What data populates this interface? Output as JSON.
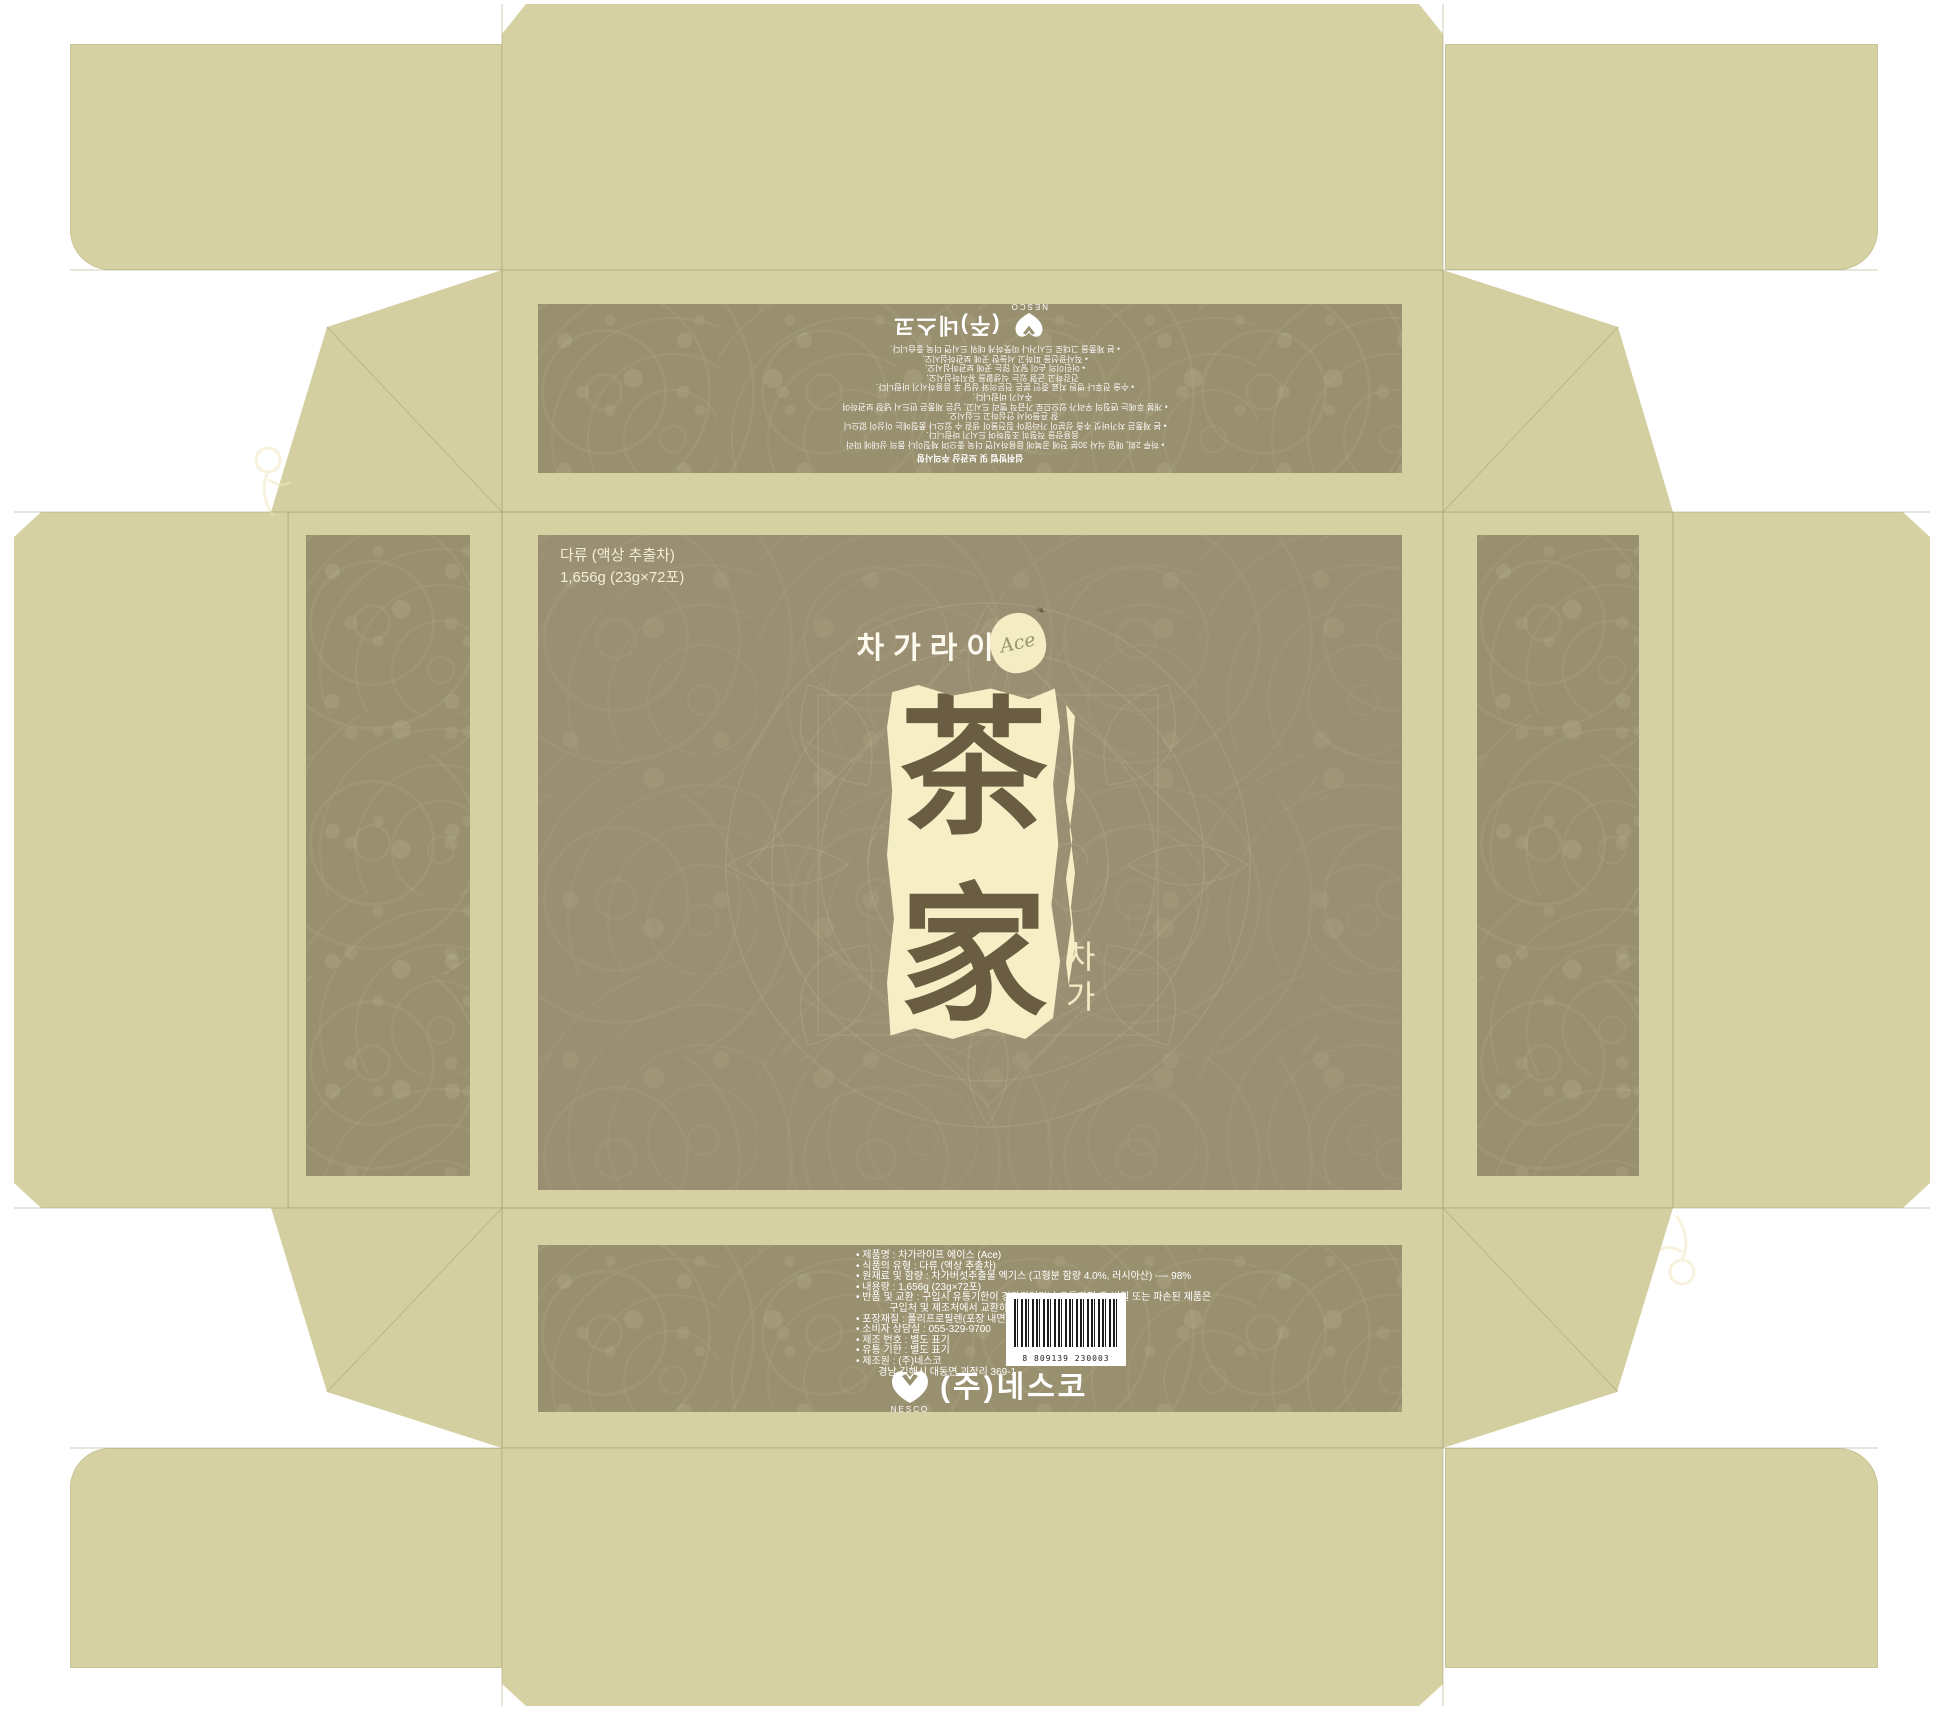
{
  "product": {
    "type_label": "다류 (액상 추출차)",
    "weight_label": "1,656g (23g×72포)",
    "brand_kr": "차가라이프",
    "brand_badge": "Ace",
    "hanzi_top": "茶",
    "hanzi_bottom": "家",
    "subtitle_vertical": [
      "차",
      "가"
    ]
  },
  "lid": {
    "heading": "섭취방법 및 보관상 주의사항",
    "lines": [
      "• 하루 2회, 매일 식사 30분 전에 공복에 음용하시면 더욱 좋으며 체질이나 몸의 상태에 따라",
      "  음용량을 적절히 조절하여 드시기 바랍니다.",
      "• 본 제품은 차가버섯 추출 성분이 가라앉아 침전물이 생길 수 있으나 품질에는 이상이 없으니",
      "  잘 흔들어서 안심하고 드십시오.",
      "• 개봉 후에는 변질의 우려가 있으므로 가급적 빨리 드시고, 남은 제품은 반드시 냉장 보관하여",
      "  주시기 바랍니다.",
      "• 수술 전후나 병원 치료 중인 분은 전문의와 상담 후 음용하시기 바랍니다.",
      "  건강하고 균형 있는 식생활을 유지하십시오.",
      "• 어린이의 손이 닿지 않는 곳에 보관하십시오.",
      "• 직사광선을 피하고 서늘한 곳에 보관하십시오.",
      "• 본 제품을 그대로 드시거나 따뜻하게 데워 드시면 더욱 좋습니다."
    ]
  },
  "info_panel": {
    "lines": [
      "• 제품명 : 차가라이프 에이스 (Ace)",
      "• 식품의 유형 : 다류 (액상 추출차)",
      "• 원재료 및 함량 : 차가버섯추출물 엑기스 (고형분 함량 4.0%, 러시아산) ---- 98%",
      "• 내용량 : 1,656g (23g×72포)",
      "• 반품 및 교환 : 구입시 유통기한이 경과되었거나 유통과정 중 변질 또는 파손된 제품은",
      "            구입처 및 제조처에서 교환하여 드립니다.",
      "• 포장재질 : 폴리프로필렌(포장 내면)",
      "• 소비자 상담실 : 055-329-9700",
      "• 제조 번호 : 별도 표기",
      "• 유통 기한 : 별도 표기",
      "• 제조원 : (주)네스코",
      "        경남 김해시 대동면 괴정리 369-1"
    ],
    "barcode_number": "8 809139 230003"
  },
  "logo": {
    "company_kr": "(주)네스코",
    "company_en": "NESCO"
  },
  "colors": {
    "khaki": "#d5d1a3",
    "panel_brown": "#9a8f72",
    "band_brown": "#99906f",
    "cream": "#f6efc5",
    "ink_brown": "#6b5d42",
    "text_white": "#ffffff"
  }
}
